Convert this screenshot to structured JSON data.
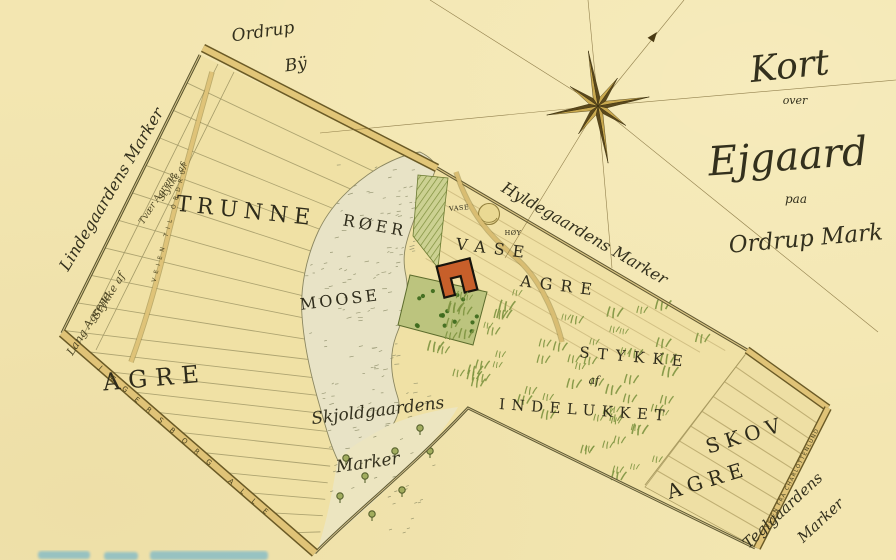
{
  "title": {
    "kort": "Kort",
    "over": "over",
    "estate": "Ejgaard",
    "paa": "paa",
    "place": "Ordrup Mark"
  },
  "village": {
    "line1": "Ordrup",
    "line2": "Bÿ"
  },
  "neighbors": {
    "lindegaard": "Lindegaardens Marker",
    "hyldegaard": "Hyldegaardens Marker",
    "skjoldgaard_line1": "Skjoldgaardens",
    "skjoldgaard_line2": "Marker",
    "teglgaard_line1": "Teglgaardens",
    "teglgaard_line2": "Marker"
  },
  "fields": {
    "trunne": "TRUNNE",
    "trunne_agre": "AGRE",
    "tvaer_line1": "Stykke af",
    "tvaer_line2": "Tvær Agrene",
    "lang_line1": "Stykke af",
    "lang_line2": "Lang Agrene",
    "roer": "RØER",
    "moose": "MOOSE",
    "vase": "VASE",
    "vase_agre": "AGRE",
    "hoy_line1": "VASE",
    "hoy_line2": "HØY",
    "stykke": "STYKKE",
    "af": "af",
    "indelukket": "INDELUKKET",
    "skov": "SKOV",
    "skov_agre": "AGRE"
  },
  "roads": {
    "jaegersborg": "JÆGERSBORG ALLE",
    "charlottenlund": "VEIEN FRA CHARLOTTENLUND",
    "ordrup_path": "VEIEN TIL ORDRUP"
  },
  "colors": {
    "parchment": "#f3e6b1",
    "ink": "#33301d",
    "road_fill": "#dfc378",
    "road_edge": "#6e5e28",
    "bog_fill": "#e8e3c6",
    "garden_green": "#bcc47e",
    "tuft_green": "#7d9440",
    "building_red": "#c75f2a",
    "compass_gold": "#c9a94f",
    "compass_dark": "#5a481b",
    "faded_blue": "#2e9fe0"
  }
}
